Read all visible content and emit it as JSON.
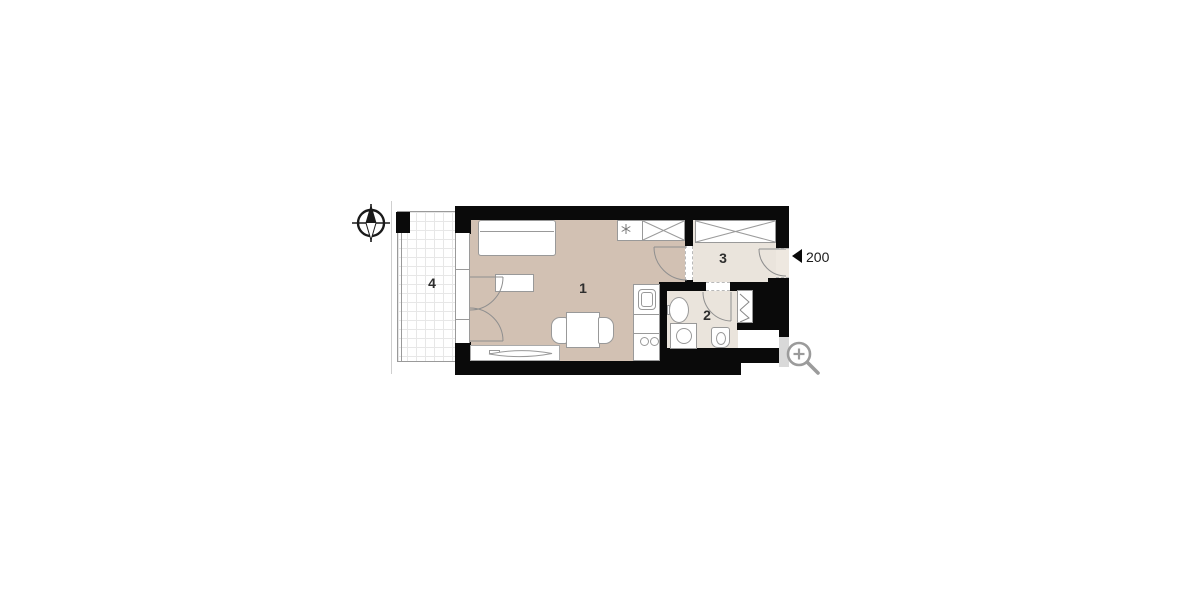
{
  "app": {
    "type": "floor-plan-viewer"
  },
  "floor_plan": {
    "room_labels": [
      {
        "number": "1",
        "role": "living-room-with-kitchenette"
      },
      {
        "number": "2",
        "role": "bathroom"
      },
      {
        "number": "3",
        "role": "entrance-hall"
      },
      {
        "number": "4",
        "role": "balcony"
      }
    ],
    "entrance_marker": {
      "text": "200"
    },
    "icons": [
      "compass-icon",
      "zoom-icon",
      "entrance-direction-triangle"
    ],
    "colors": {
      "wall": "#0a0a0a",
      "main_room_fill": "#d2c1b3",
      "secondary_room_fill": "#eae4dc",
      "furniture_outline": "#999999",
      "door_arc": "#8f8f8f",
      "balcony_grid": "#e7e7e7",
      "shaft_fill": "#d9d9d9",
      "magnifier": "#9b9b9b"
    }
  }
}
